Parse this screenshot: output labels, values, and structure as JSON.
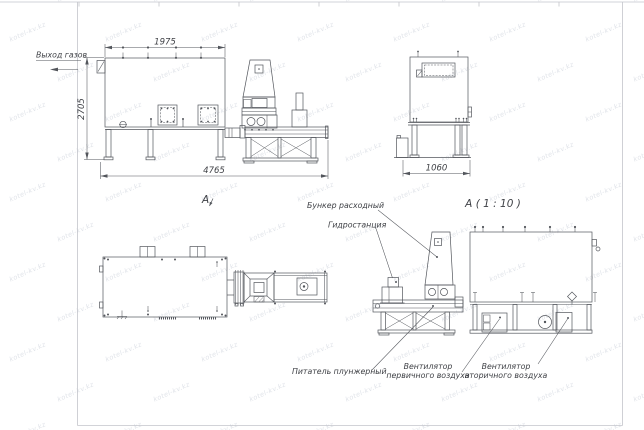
{
  "watermark": {
    "text": "kotel-kv.kz"
  },
  "colors": {
    "line": "#53565c",
    "text": "#3f4146",
    "frame": "#c3c5cb",
    "watermark": "#d8dce4"
  },
  "views": {
    "side": {
      "dims": {
        "width_top": "1975",
        "height": "2705",
        "length": "4765"
      },
      "labels": {
        "gas_outlet": "Выход газов"
      }
    },
    "end": {
      "dims": {
        "width": "1060"
      }
    },
    "plan": {
      "marker": "А"
    },
    "detail": {
      "title": "А ( 1 : 10 )",
      "labels": {
        "hopper": "Бункер расходный",
        "hydraulic": "Гидростанция",
        "feeder": "Питатель плунжерный",
        "fan_primary_line1": "Вентилятор",
        "fan_primary_line2": "первичного воздуха",
        "fan_secondary_line1": "Вентилятор",
        "fan_secondary_line2": "вторичного воздуха"
      }
    }
  }
}
